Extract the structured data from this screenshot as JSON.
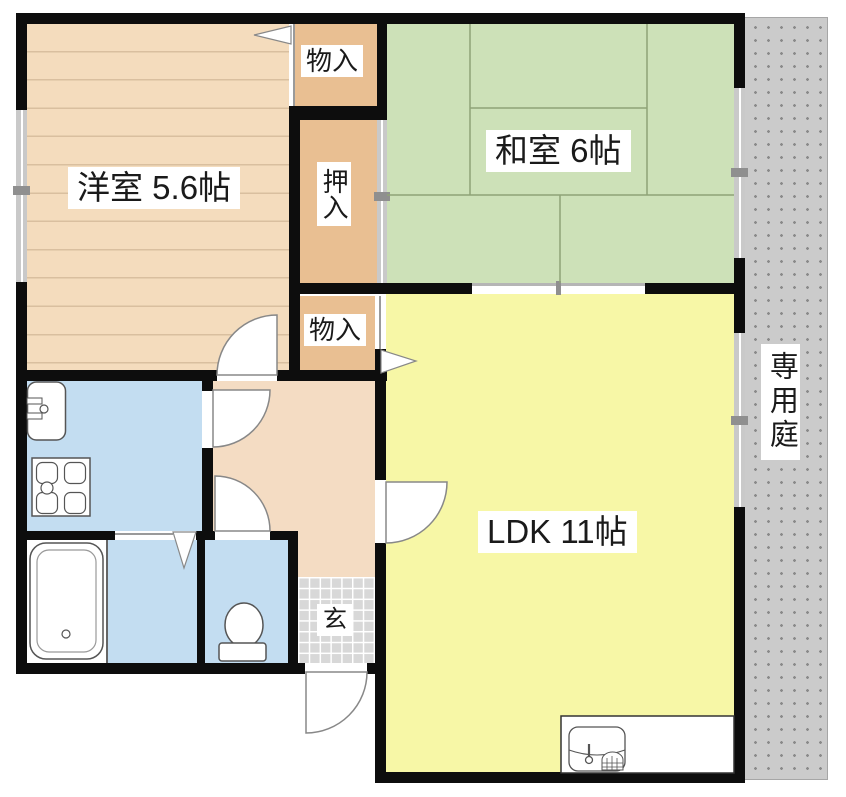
{
  "floorplan": {
    "rooms": {
      "western_room": {
        "label": "洋室 5.6帖"
      },
      "japanese_room": {
        "label": "和室 6帖"
      },
      "ldk": {
        "label": "LDK 11帖"
      },
      "closet": {
        "label": "押入"
      },
      "storage_top": {
        "label": "物入"
      },
      "storage_bottom": {
        "label": "物入"
      },
      "entrance": {
        "label": "玄"
      },
      "private_garden": {
        "label": "専用庭"
      }
    },
    "fixtures": [
      "kitchen-sink",
      "gas-stove",
      "bathtub",
      "toilet",
      "kitchen-counter-sink",
      "hinged-doors",
      "sliding-fusuma",
      "windows",
      "entrance-door",
      "folding-door"
    ],
    "colors": {
      "wall": "#0d0d0d",
      "western_room_floor": "#f4dcbd",
      "western_room_floor_line": "#d9bf9f",
      "closet": "#e9bf92",
      "hall": "#f4dcc3",
      "tatami": "#cde1b8",
      "tatami_line": "#8fa377",
      "ldk": "#f7f7a6",
      "water_rooms": "#c3ddf1",
      "garden": "#cbcbcb",
      "garden_dot": "#8a8a8a",
      "entrance_tile": "#d8d8d8"
    }
  }
}
